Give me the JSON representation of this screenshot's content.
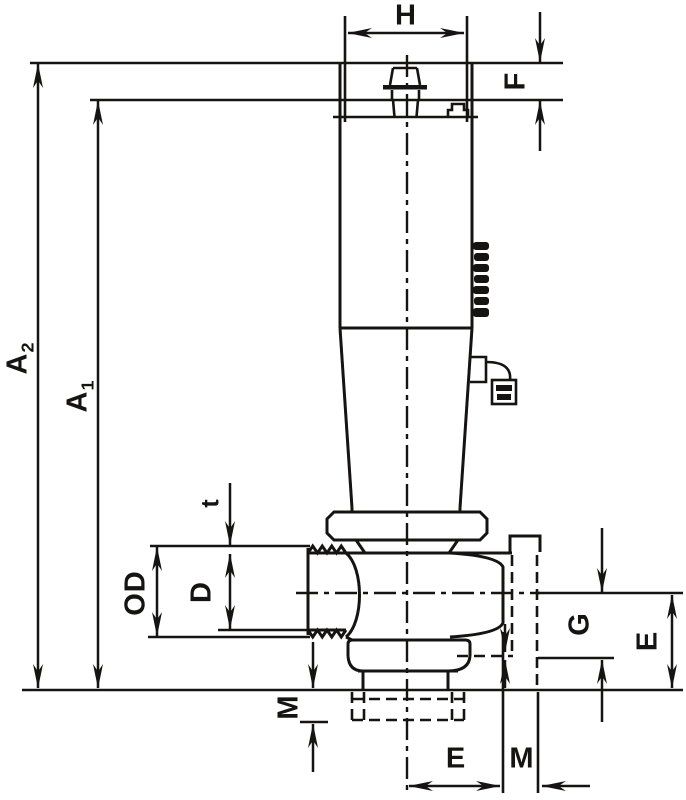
{
  "drawing": {
    "type": "engineering-dimension-drawing",
    "line_color": "#161412",
    "background": "#ffffff"
  },
  "labels": {
    "h": "H",
    "f": "F",
    "a2": {
      "base": "A",
      "sub": "2"
    },
    "a1": {
      "base": "A",
      "sub": "1"
    },
    "t": "t",
    "od": "OD",
    "d": "D",
    "m_left": "M",
    "g": "G",
    "e_right": "E",
    "e_bottom": "E",
    "m_bottom": "M"
  }
}
